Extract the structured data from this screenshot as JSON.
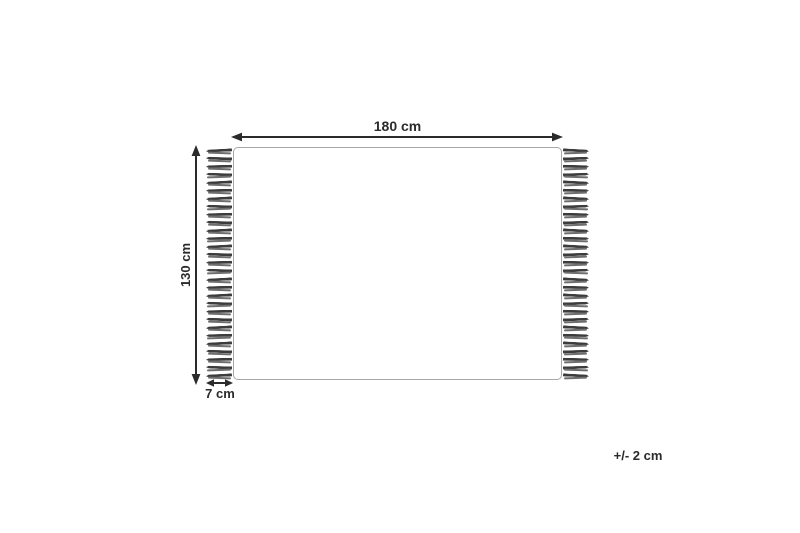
{
  "diagram": {
    "width_label": "180 cm",
    "height_label": "130 cm",
    "fringe_length_label": "7 cm",
    "tolerance_label": "+/- 2 cm",
    "fringe": {
      "tassel_count_per_side": 29
    },
    "colors": {
      "line": "#2b2b2b",
      "rug_border": "#a8a8a8",
      "tassel": "#3c3c3c",
      "tassel_secondary": "#6e6e6e",
      "background": "#ffffff"
    }
  }
}
